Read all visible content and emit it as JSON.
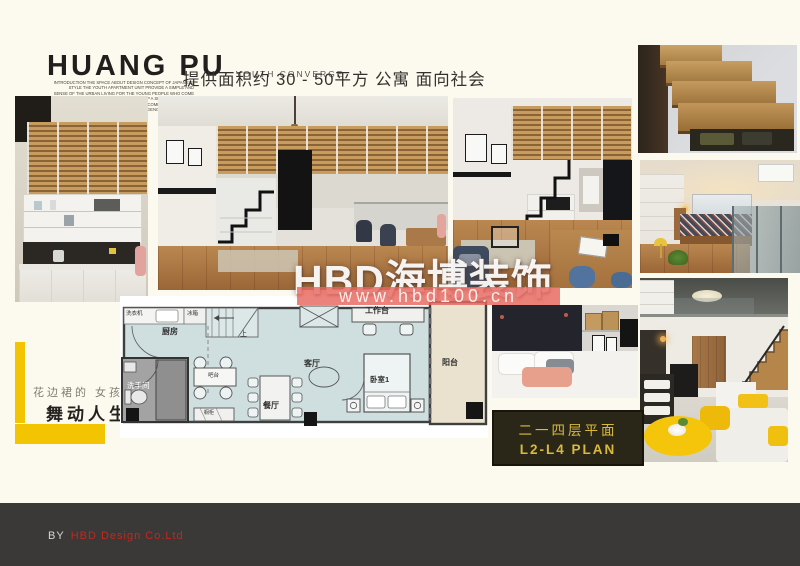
{
  "header": {
    "brand": "HUANG PU",
    "brand_sub": "YOUTH CONVERGE",
    "fineprint_1": "INTRODUCTION THE SPACE ABOUT DESIGN CONCEPT OF JAPANESE STYLE THE YOUTH APARTMENT UNIT PROVIDE A SIMPLE AND",
    "fineprint_2": "SENSE OF THE URBAN LIVING FOR THE YOUNG PEOPLE WHO COME TO THE CITY WITH A DREAM AND KEEP A SIMPLE WARM LIFE",
    "fineprint_3": "THE DESIGN GIVES A SMALL BUT COMPLETE HOME AND CONVERGENCE OF THE YOUTH",
    "tagline": "提供面积约 30 - 50平方 公寓 面向社会"
  },
  "watermark": {
    "brand": "HBD海博装饰",
    "url": "www.hbd100.cn",
    "banner_color": "#e7675f"
  },
  "side_note": {
    "line1": "花边裙的  女孩",
    "line2": "舞动人生",
    "accent": "#f3c402"
  },
  "floor_plan": {
    "labels": {
      "washer": "洗衣机",
      "fridge": "冰箱",
      "kitchen": "厨房",
      "up": "上",
      "workdesk": "工作台",
      "living": "客厅",
      "bedroom": "卧室1",
      "balcony": "阳台",
      "bathroom": "洗手间",
      "bar": "吧台",
      "dining": "餐厅",
      "cabinet": "橱柜"
    },
    "room_fill": "#cfdfe0",
    "balcony_fill": "#eae2cf"
  },
  "plan_card": {
    "line1": "二一四层平面",
    "line2": "L2-L4  PLAN",
    "text_color": "#d9ba3e"
  },
  "footer": {
    "prefix": "BY",
    "company": "HBD Design Co.Ltd",
    "company_color": "#c6271d"
  }
}
